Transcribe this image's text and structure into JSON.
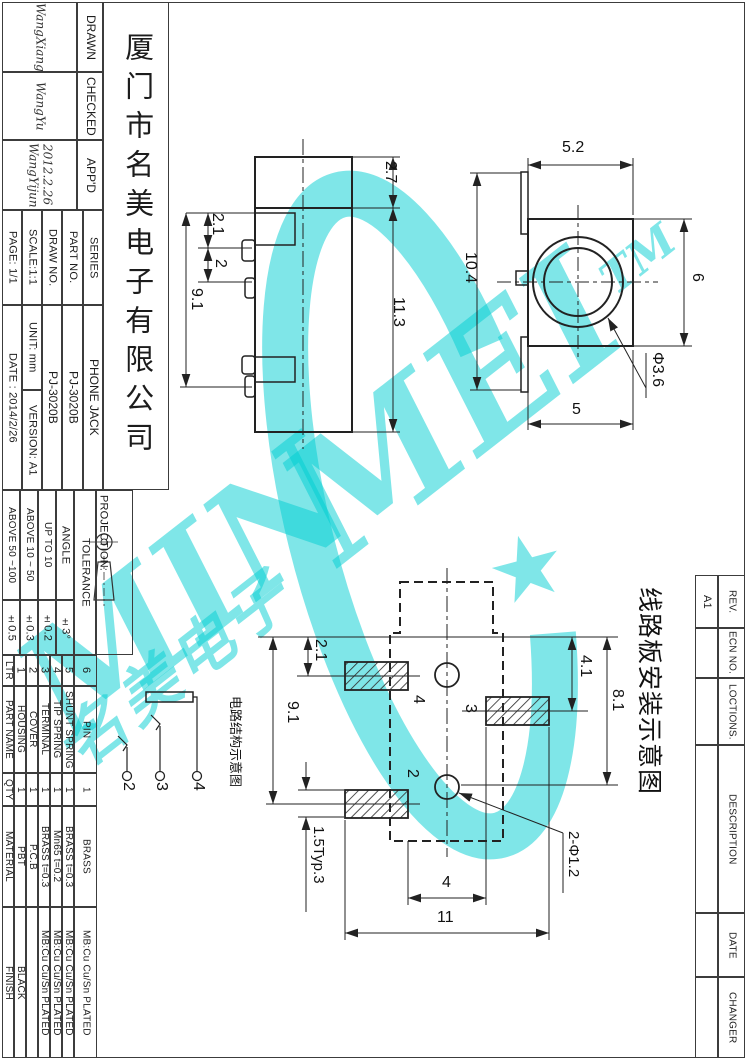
{
  "title_block": {
    "company": "厦门市名美电子有限公司",
    "approvals": [
      {
        "label": "DRAWN",
        "value": "WangXiang"
      },
      {
        "label": "CHECKED",
        "value": "WangYu"
      },
      {
        "label": "APP'D",
        "value": "WangYijun",
        "value2": "2012.2.26"
      }
    ],
    "cols": [
      {
        "header": "PAGE: 1/1",
        "value": "DATE : 2014/2/26"
      },
      {
        "header": "SCALE:1:1",
        "value": "UNIT: mm",
        "value2": "VERSION: A1"
      },
      {
        "header": "DRAW NO.",
        "value": "PJ-3020B"
      },
      {
        "header": "PART NO.",
        "value": "PJ-3020B"
      },
      {
        "header": "SERIES",
        "value": "PHONE JACK"
      }
    ]
  },
  "tolerance_block": {
    "projection_label": "PROJECTION:",
    "tolerance_label": "TOLERANCE",
    "rows": [
      {
        "range": "ANGLE",
        "value": "±3°"
      },
      {
        "range": "UP TO 10",
        "value": "±0.2"
      },
      {
        "range": "ABOVE 10 ~ 50",
        "value": "±0.3"
      },
      {
        "range": "ABOVE 50 ~100",
        "value": "±0.5"
      }
    ]
  },
  "parts_table": {
    "headers": {
      "ltr": "LTR",
      "part_name": "PART NAME",
      "qty": "QTY",
      "material": "MATERIAL",
      "finish": "FINISH"
    },
    "rows": [
      {
        "ltr": "6",
        "part_name": "PIN",
        "qty": "1",
        "material": "BRASS",
        "finish": "MB:Cu  Cu/Sn  PLATED"
      },
      {
        "ltr": "5",
        "part_name": "SHUNT SPRING",
        "qty": "1",
        "material": "BRASS  t=0.3",
        "finish": "MB:Cu  Cu/Sn  PLATED"
      },
      {
        "ltr": "4",
        "part_name": "TIP SPRING",
        "qty": "1",
        "material": "Mn65  t=0.2",
        "finish": "MB:Cu  Cu/Sn  PLATED"
      },
      {
        "ltr": "3",
        "part_name": "TERMINAL",
        "qty": "1",
        "material": "BRASS  t=0.3",
        "finish": "MB:Cu  Cu/Sn  PLATED"
      },
      {
        "ltr": "2",
        "part_name": "COVER",
        "qty": "1",
        "material": "P.C.B",
        "finish": ""
      },
      {
        "ltr": "1",
        "part_name": "HOUSING",
        "qty": "1",
        "material": "PBT",
        "finish": "BLACK"
      }
    ]
  },
  "revision_block": {
    "headers": [
      "REV.",
      "ECN NO.",
      "LOCTIONS.",
      "DESCRIPTION",
      "DATE",
      "CHANGER"
    ],
    "rev_value": "A1"
  },
  "drawings": {
    "side_view": {
      "dims": [
        "2.7",
        "11.3",
        "2.1",
        "2",
        "9.1"
      ]
    },
    "front_view": {
      "dims": [
        "5.2",
        "10.4",
        "6",
        "5"
      ],
      "hole_label": "Φ3.6"
    },
    "pcb_layout": {
      "title": "线路板安装示意图",
      "dims": [
        "2.1",
        "9.1",
        "4.1",
        "8.1",
        "4",
        "11"
      ],
      "pitch_label": "1.5Typ.3",
      "holes_label": "2-Φ1.2",
      "pad_labels": [
        "4",
        "3",
        "2"
      ]
    },
    "schematic": {
      "title": "电路结构示意图",
      "pin_labels": [
        "2",
        "3",
        "4"
      ]
    }
  },
  "watermark": {
    "text_left": "MIN",
    "text_right": "MEI",
    "tm": "TM",
    "star": "★",
    "chinese": "名美电子",
    "color": "#00CED1"
  }
}
